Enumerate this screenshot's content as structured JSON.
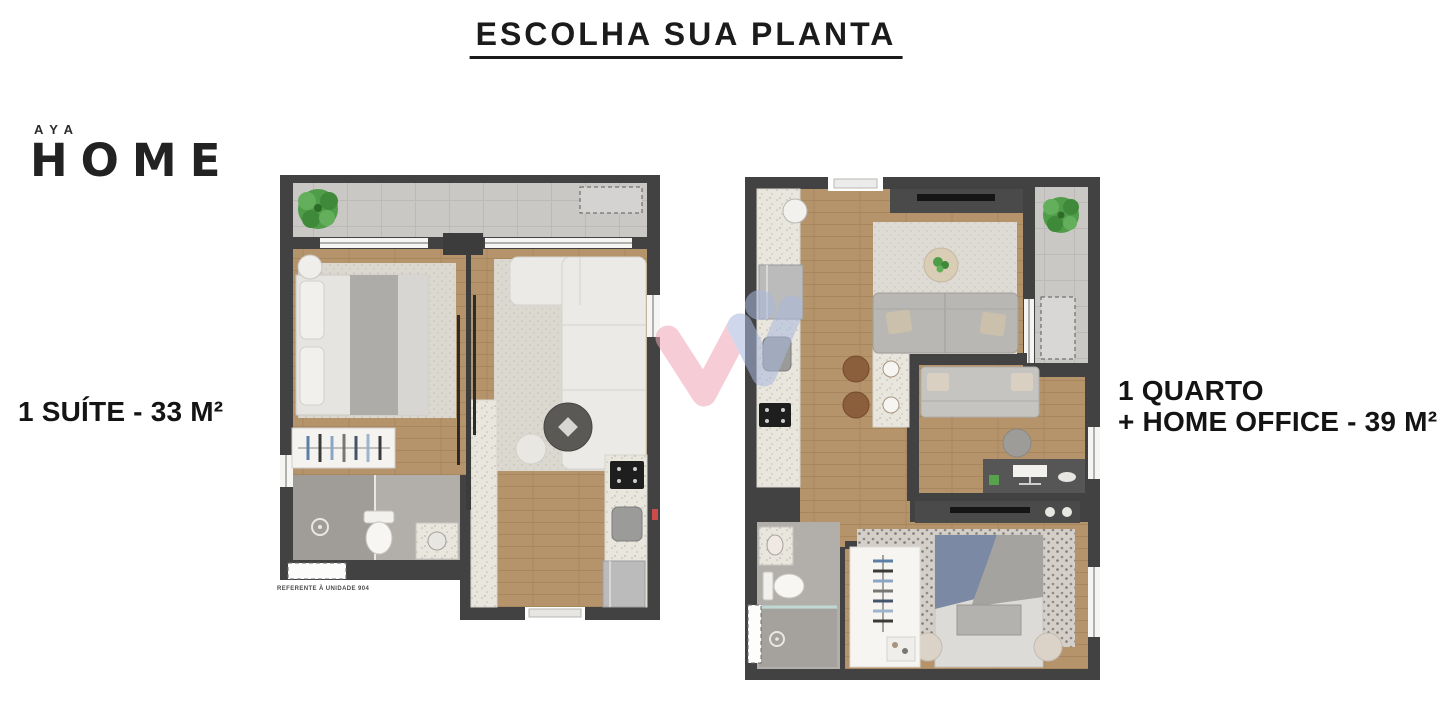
{
  "page": {
    "title": "ESCOLHA SUA PLANTA",
    "background_color": "#ffffff"
  },
  "logo": {
    "top_text": "AYA",
    "main_text": "HOME",
    "color": "#222222"
  },
  "plans": {
    "left": {
      "label": "1 SUÍTE - 33 M²",
      "caption": "REFERENTE À UNIDADE 904"
    },
    "right": {
      "label_line1": "1 QUARTO",
      "label_line2": "+ HOME OFFICE - 39 M²"
    }
  },
  "watermark": {
    "pink": "#efa6b8",
    "blue": "#a9b8dd"
  },
  "palette": {
    "wall": "#424242",
    "wood_floor": "#b5946c",
    "balcony_tile": "#c9c8c5",
    "bathroom_floor": "#aeaba6",
    "counter_speckle": "#e9e6de",
    "dark_furniture": "#4d4d4d",
    "tv_black": "#151515",
    "plant_green": "#4f9d49",
    "stool_brown": "#8b5e3c",
    "bed_blanket_blue": "#7c89a4",
    "accent_red_marker": "#cc4b4b",
    "text": "#141414"
  }
}
